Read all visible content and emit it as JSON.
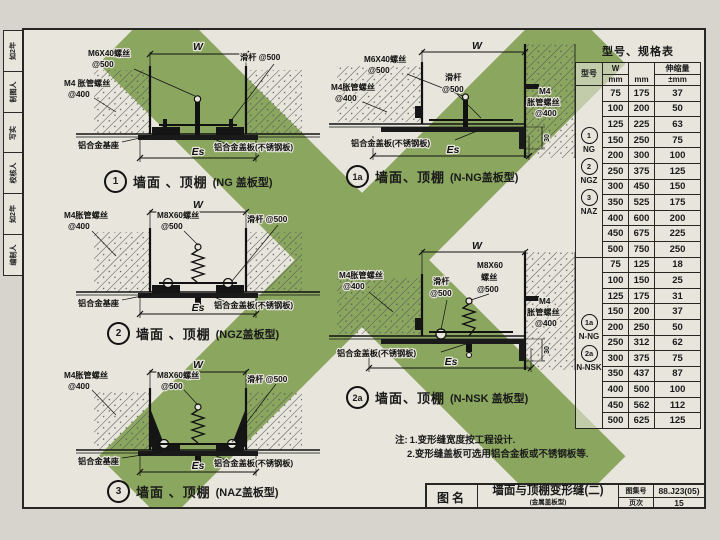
{
  "sidebar": {
    "cells": [
      "如2年",
      "制图人",
      "写实",
      "校核人",
      "如2年",
      "编制人"
    ]
  },
  "details": {
    "d1": {
      "badge": "1",
      "caption": "墙面 、顶棚",
      "type": "(NG 盖板型)",
      "screw1": "M6X40螺丝",
      "screw2": "@500",
      "slider": "滑杆 @500",
      "anchor1": "M4 胀管螺丝",
      "anchor2": "@400",
      "base": "铝合金基座",
      "cover": "铝合金盖板(不锈钢板)",
      "w": "W",
      "es": "Es"
    },
    "d1a": {
      "badge": "1a",
      "caption": "墙面、顶棚",
      "type": "(N-NG盖板型)",
      "screw1": "M6X40螺丝",
      "screw2": "@500",
      "anchorl1": "M4胀管螺丝",
      "anchorl2": "@400",
      "slider1": "滑杆",
      "slider2": "@500",
      "anchorr1": "M4",
      "anchorr2": "胀管螺丝",
      "anchorr3": "@400",
      "cover": "铝合金盖板(不锈钢板)",
      "w": "W",
      "es": "Es",
      "dim30": "30"
    },
    "d2": {
      "badge": "2",
      "caption": "墙面 、顶棚",
      "type": "(NGZ盖板型)",
      "anchor1": "M4胀管螺丝",
      "anchor2": "@400",
      "screw1": "M8X60螺丝",
      "screw2": "@500",
      "slider": "滑杆 @500",
      "base": "铝合金基座",
      "cover": "铝合金盖板(不锈钢板)",
      "w": "W",
      "es": "Es"
    },
    "d2a": {
      "badge": "2a",
      "caption": "墙面、顶棚",
      "type": "(N-NSK 盖板型)",
      "anchorl1": "M4胀管螺丝",
      "anchorl2": "@400",
      "slider1": "滑杆",
      "slider2": "@500",
      "screw1": "M8X60",
      "screw2": "螺丝",
      "screw3": "@500",
      "anchorr1": "M4",
      "anchorr2": "胀管螺丝",
      "anchorr3": "@400",
      "cover": "铝合金盖板(不锈钢板)",
      "w": "W",
      "es": "Es",
      "dim30": "30"
    },
    "d3": {
      "badge": "3",
      "caption": "墙面 、顶棚",
      "type": "(NAZ盖板型)",
      "anchor1": "M4胀管螺丝",
      "anchor2": "@400",
      "screw1": "M8X60螺丝",
      "screw2": "@500",
      "slider": "滑杆 @500",
      "base": "铝合金基座",
      "cover": "铝合金盖板(不锈钢板)",
      "w": "W",
      "es": "Es"
    }
  },
  "spec_table": {
    "title": "型号、规格表",
    "headers": {
      "model": "型号",
      "w": "W",
      "w_unit": "mm",
      "mid": "mm",
      "stretch": "伸缩量",
      "stretch_unit": "±mm"
    },
    "groups": [
      {
        "models": [
          {
            "circle": "1"
          },
          {
            "text": "NG"
          },
          {
            "circle": "2"
          },
          {
            "text": "NGZ"
          },
          {
            "circle": "3"
          },
          {
            "text": "NAZ"
          }
        ],
        "rows": [
          [
            "75",
            "175",
            "37"
          ],
          [
            "100",
            "200",
            "50"
          ],
          [
            "125",
            "225",
            "63"
          ],
          [
            "150",
            "250",
            "75"
          ],
          [
            "200",
            "300",
            "100"
          ],
          [
            "250",
            "375",
            "125"
          ],
          [
            "300",
            "450",
            "150"
          ],
          [
            "350",
            "525",
            "175"
          ],
          [
            "400",
            "600",
            "200"
          ],
          [
            "450",
            "675",
            "225"
          ],
          [
            "500",
            "750",
            "250"
          ]
        ]
      },
      {
        "models": [
          {
            "circle": "1a"
          },
          {
            "text": "N-NG"
          },
          {
            "circle": "2a"
          },
          {
            "text": "N-NSK"
          }
        ],
        "rows": [
          [
            "75",
            "125",
            "18"
          ],
          [
            "100",
            "150",
            "25"
          ],
          [
            "125",
            "175",
            "31"
          ],
          [
            "150",
            "200",
            "37"
          ],
          [
            "200",
            "250",
            "50"
          ],
          [
            "250",
            "312",
            "62"
          ],
          [
            "300",
            "375",
            "75"
          ],
          [
            "350",
            "437",
            "87"
          ],
          [
            "400",
            "500",
            "100"
          ],
          [
            "450",
            "562",
            "112"
          ],
          [
            "500",
            "625",
            "125"
          ]
        ]
      }
    ]
  },
  "notes": {
    "prefix": "注:",
    "line1": "1.变形缝宽度按工程设计.",
    "line2": "2.变形缝盖板可选用铝合金板或不锈钢板等."
  },
  "title_block": {
    "name_label": "图名",
    "title": "墙面与顶棚变形缝(二)",
    "subtitle": "(金属盖板型)",
    "atlas_label": "图集号",
    "atlas_no": "88.J23(05)",
    "page_label": "页次",
    "page_no": "15"
  },
  "colors": {
    "watermark_green": "#8aa65f",
    "paper": "#e7e5dc",
    "ink": "#1a1a1a"
  }
}
